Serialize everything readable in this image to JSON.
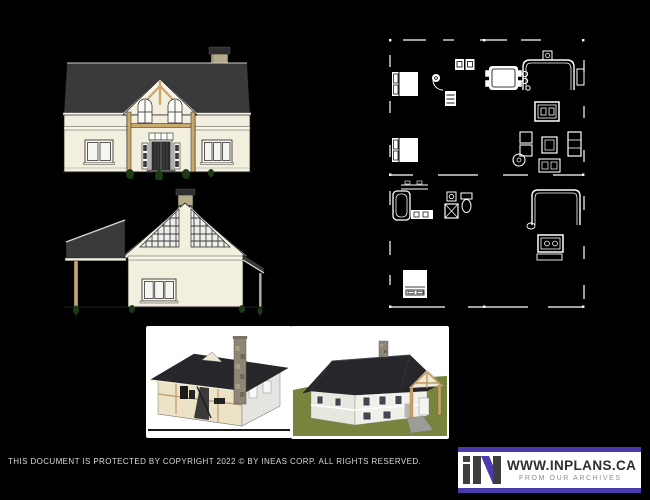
{
  "canvas": {
    "background": "#000000"
  },
  "footer": {
    "copyright": "THIS DOCUMENT IS PROTECTED BY COPYRIGHT 2022 ©  BY INEAS CORP. ALL RIGHTS RESERVED."
  },
  "logo": {
    "mark": "iN",
    "website": "WWW.INPLANS.CA",
    "tagline": "FROM OUR ARCHIVES",
    "colors": {
      "accent": "#4a3aab",
      "box": "#ffffff",
      "text": "#2e2e2e",
      "tagline": "#8f8f8f",
      "mark": "#3e3e3e"
    }
  },
  "palette": {
    "roof": "#3a3a3c",
    "wall": "#f3efdf",
    "trim": "#f8f5e8",
    "timber": "#c9a96d",
    "chimney": "#b5ab8b",
    "door": "#2b2b2b",
    "glass": "#f5f5f2",
    "plant": "#1d3a16",
    "plan_line": "#ffffff",
    "render_roof": "#26262b",
    "render_wall": "#ececE4",
    "interior_wall": "#ece3c6",
    "stone": "#8e8674",
    "lawn": "#76843e",
    "floor_slab": "#989898"
  }
}
